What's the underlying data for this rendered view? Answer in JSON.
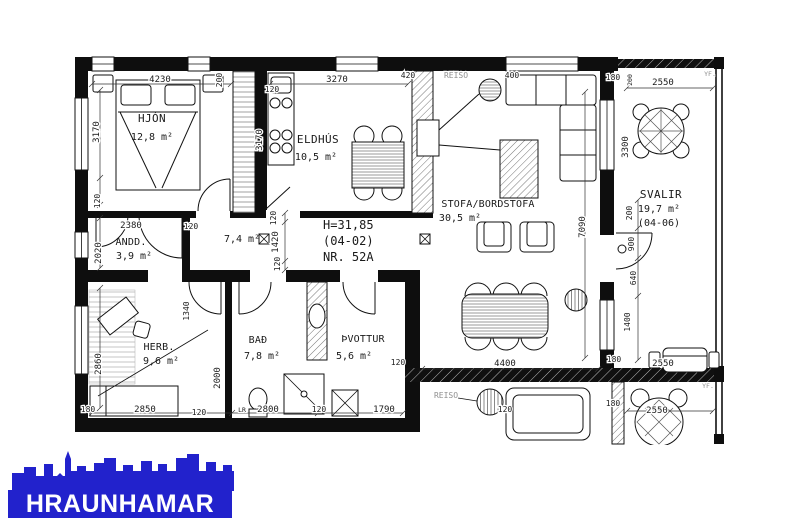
{
  "plan": {
    "title_block": {
      "height_line": "H=31,85",
      "unit_line": "(04-02)",
      "number_line": "NR. 52A"
    },
    "rooms": {
      "hjon": {
        "name": "HJÓN",
        "area": "12,8 m²"
      },
      "eldhus": {
        "name": "ELDHÚS",
        "area": "10,5 m²"
      },
      "stofa": {
        "name": "STOFA/BORDSTOFA",
        "area": "30,5 m²"
      },
      "andd": {
        "name": "ANDD.",
        "area": "3,9 m²"
      },
      "hall": {
        "area": "7,4 m²"
      },
      "herb": {
        "name": "HERB.",
        "area": "9,6 m²"
      },
      "bad": {
        "name": "BAÐ",
        "area": "7,8 m²"
      },
      "thvottur": {
        "name": "ÞVOTTUR",
        "area": "5,6 m²"
      },
      "svalir": {
        "name": "SVALIR",
        "area": "19,7 m²",
        "unit_code": "(04-06)"
      }
    },
    "small_labels": {
      "reiso": "REISO",
      "lr": "LR",
      "yf": "YF."
    },
    "dims": {
      "d4230": "4230",
      "d3170": "3170",
      "d3270": "3270",
      "d420": "420",
      "d400": "400",
      "d2380": "2380",
      "d2020": "2020",
      "d1420": "1420",
      "d2850": "2850",
      "d2860": "2860",
      "d2800": "2800",
      "d1790": "1790",
      "d2000": "2000",
      "d1340": "1340",
      "d4400": "4400",
      "d7090": "7090",
      "d2550": "2550",
      "d3300": "3300",
      "d1400": "1400",
      "d900": "900",
      "d640": "640",
      "d200": "200",
      "d120": "120",
      "d180": "180"
    }
  },
  "logo": {
    "name": "HRAUNHAMAR",
    "brand_blue": "#2222cc"
  }
}
